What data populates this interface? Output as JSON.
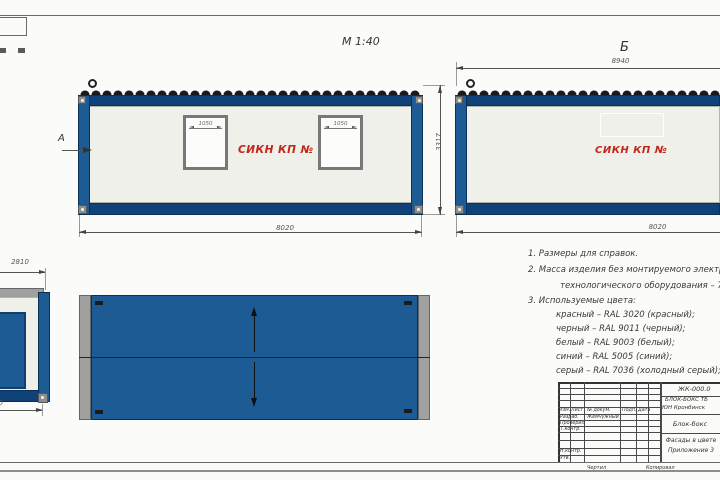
{
  "scale_label": "М 1:40",
  "views": {
    "front": {
      "section_label": "А",
      "sign": "СИКН КП №",
      "window1_width": "1050",
      "window2_width": "1050",
      "bottom_width": "8020",
      "height": "3317"
    },
    "side": {
      "label": "Б",
      "sign": "СИКН КП №",
      "top_width": "8940",
      "bottom_width": "8020"
    },
    "end": {
      "top_width": "2810",
      "bottom_width_partial": "50"
    }
  },
  "notes": [
    "1. Размеры для справок.",
    "2. Масса изделия без монтируемого электрооборудования,",
    "технологического оборудования – 7300 кг.",
    "3. Используемые цвета:",
    "красный – RAL 3020 (красный);",
    "черный – RAL 9011 (черный);",
    "белый – RAL 9003 (белый);",
    "синий – RAL 5005 (синий);",
    "серый – RAL 7036 (холодный серый);"
  ],
  "title_block": {
    "doc_number": "ЖК-000.0",
    "object_line1": "БЛОК-БОКС ТБ",
    "object_line2": "ЮН Кронбинск",
    "item_name": "Блок-бокс",
    "sheet_title_line1": "Фасады в цвете",
    "sheet_title_line2": "Приложение 3",
    "columns": [
      "Изм.",
      "Лист",
      "№ докум.",
      "Подп.",
      "Дата"
    ],
    "rows": [
      "Разраб.",
      "Проверил",
      "Т.контр.",
      "Н.контр.",
      "Утв."
    ],
    "developer_name": "Жемчужный",
    "footer_left": "Чертил",
    "footer_right": "Копировал"
  },
  "colors": {
    "blue_panel": "#1d5b94",
    "blue_rail": "#0f4278",
    "wall": "#eef0e9",
    "red_label": "#c1261b",
    "gray_cap": "#a0a09e"
  }
}
